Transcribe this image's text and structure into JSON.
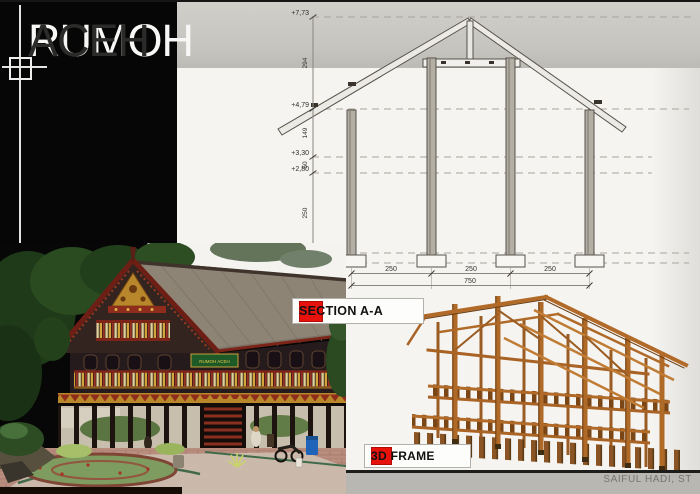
{
  "title": {
    "part1": "RUMOH",
    "part2": "ACEH"
  },
  "legend": {
    "section_label": "SECTION A-A",
    "frame_label": "3D FRAME"
  },
  "footer": {
    "credit": "SAIFUL HADI, ST"
  },
  "photo": {
    "sign_text": "RUMOH ACEH"
  },
  "colors": {
    "accent-red": "#e8120d",
    "title-band": "#c9c7c2",
    "footer-band": "#b9b7b2",
    "panel-black": "#060606",
    "page-bg": "#f5f4f1"
  },
  "section_drawing": {
    "elevations": [
      {
        "label": "+7,73"
      },
      {
        "label": "+4,79"
      },
      {
        "label": "+3,30"
      },
      {
        "label": "+2,80"
      },
      {
        "label": "+0,30"
      },
      {
        "label": "+0,00"
      }
    ],
    "vertical_dims": [
      {
        "label": "294"
      },
      {
        "label": "149"
      },
      {
        "label": "50"
      },
      {
        "label": "250"
      },
      {
        "label": "30"
      }
    ],
    "bay_dims": [
      {
        "label": "250"
      },
      {
        "label": "250"
      },
      {
        "label": "250"
      }
    ],
    "total_dim": {
      "label": "750"
    }
  }
}
